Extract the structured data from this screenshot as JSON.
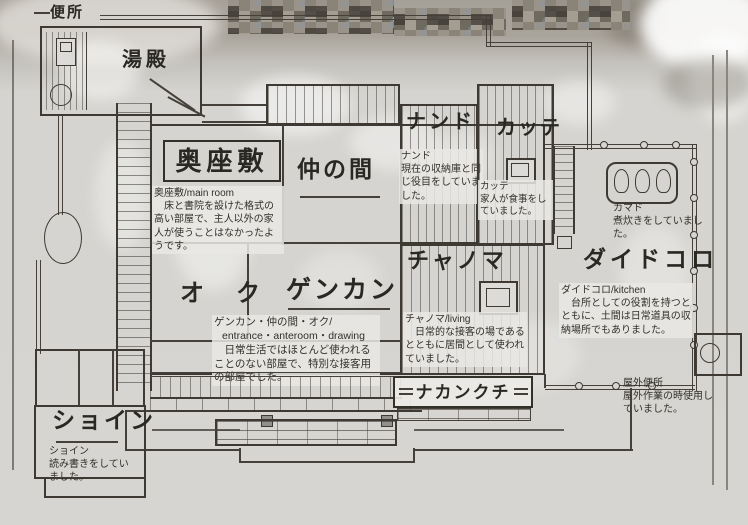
{
  "plan": {
    "rooms": {
      "benjo": {
        "label": "便所"
      },
      "yudono": {
        "label": "湯殿"
      },
      "okuzashiki": {
        "label": "奥座敷",
        "note_title": "奥座敷/main room",
        "note": "床と書院を設けた格式の高い部屋で、主人以外の家人が使うことはなかったようです。"
      },
      "nakanoma": {
        "label": "仲の間"
      },
      "nando": {
        "label": "ナンド",
        "note_title": "ナンド",
        "note": "現在の収納庫と同じ役目をしていました。"
      },
      "katte": {
        "label": "カッテ",
        "note_title": "カッテ",
        "note": "家人が食事をしていました。"
      },
      "kamado": {
        "note_title": "カマド",
        "note": "煮炊きをしていました。"
      },
      "daidokoro": {
        "label": "ダイドコロ",
        "note_title": "ダイドコロ/kitchen",
        "note": "台所としての役割を持つとともに、土間は日常道具の収納場所でもありました。"
      },
      "chanoma": {
        "label": "チャノマ",
        "note_title": "チャノマ/living",
        "note": "日常的な接客の場であるとともに居間として使われていました。"
      },
      "oku": {
        "label": "オ　ク"
      },
      "genkan": {
        "label": "ゲンカン",
        "note_title": "ゲンカン・仲の間・オク/",
        "note_subtitle": "entrance・anteroom・drawing",
        "note": "日常生活ではほとんど使われることのない部屋で、特別な接客用の部屋でした。"
      },
      "nakankuchi": {
        "label": "ナカンクチ"
      },
      "shoin": {
        "label": "ショイン",
        "note_title": "ショイン",
        "note": "読み書きをしていました。"
      },
      "outdoor_toilet": {
        "note_title": "屋外便所",
        "note": "屋外作業の時使用していました。"
      }
    },
    "colors": {
      "ink": "#3e3a33",
      "paper": "#d6d5d1",
      "photo_top": "#a6a198"
    }
  }
}
